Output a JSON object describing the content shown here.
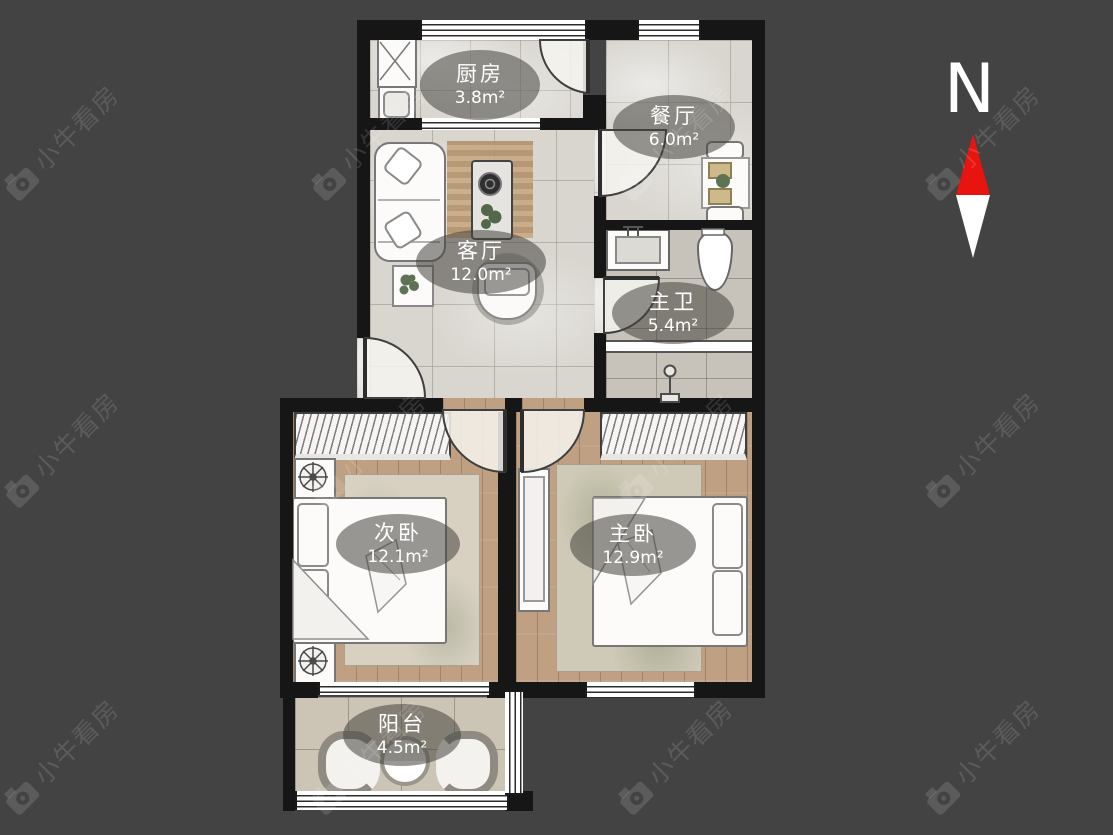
{
  "colors": {
    "background": "#434343",
    "wall": "#161616",
    "label_background": "rgba(70,68,62,0.55)",
    "label_text": "#ffffff",
    "north_arrow_red": "#e8140f",
    "north_arrow_white": "#ffffff"
  },
  "compass": {
    "label": "N"
  },
  "watermark": {
    "text": "小牛看房"
  },
  "rooms": [
    {
      "name": "厨房",
      "area": "3.8m²"
    },
    {
      "name": "餐厅",
      "area": "6.0m²"
    },
    {
      "name": "客厅",
      "area": "12.0m²"
    },
    {
      "name": "主卫",
      "area": "5.4m²"
    },
    {
      "name": "次卧",
      "area": "12.1m²"
    },
    {
      "name": "主卧",
      "area": "12.9m²"
    },
    {
      "name": "阳台",
      "area": "4.5m²"
    }
  ]
}
